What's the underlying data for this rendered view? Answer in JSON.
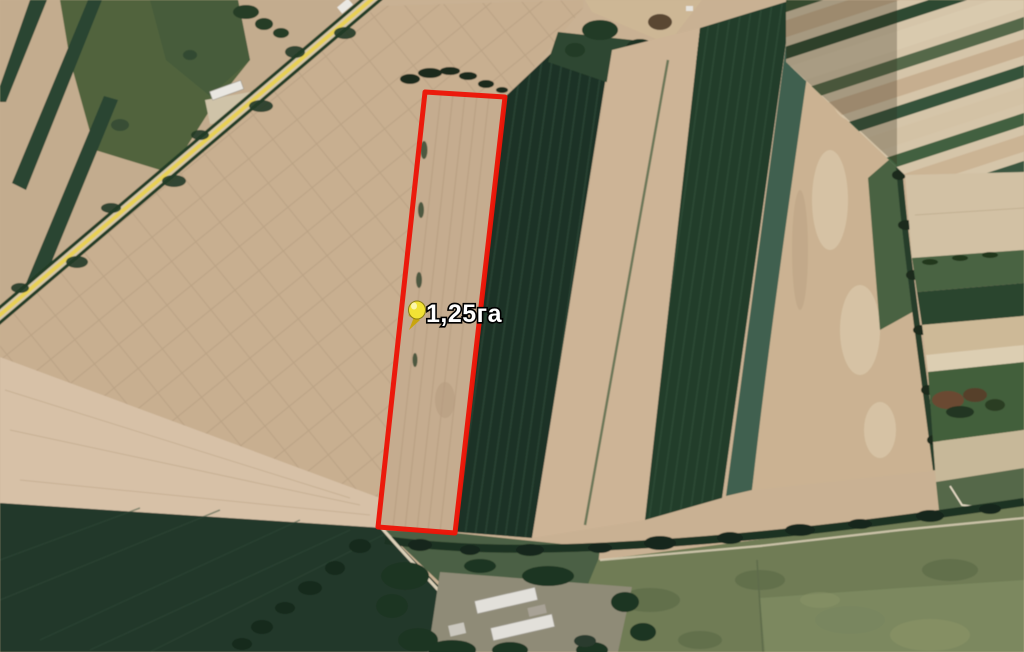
{
  "map": {
    "placemark": {
      "label": "1,25га",
      "icon": "pushpin-icon",
      "pin_color": "#f2e235",
      "pin_outline_color": "#8a7d10",
      "label_color": "#ffffff",
      "label_halo_color": "#000000"
    },
    "parcel": {
      "outline_color": "#ec1507"
    },
    "terrain_palette": {
      "soil_tan": "#c9b193",
      "soil_pale": "#d7c1a7",
      "crop_dark_green": "#1d3326",
      "crop_olive": "#6f7c55",
      "trees_dark": "#16281c",
      "road_yellow": "#e8d054",
      "barn_roof": "#e2e0da"
    }
  }
}
